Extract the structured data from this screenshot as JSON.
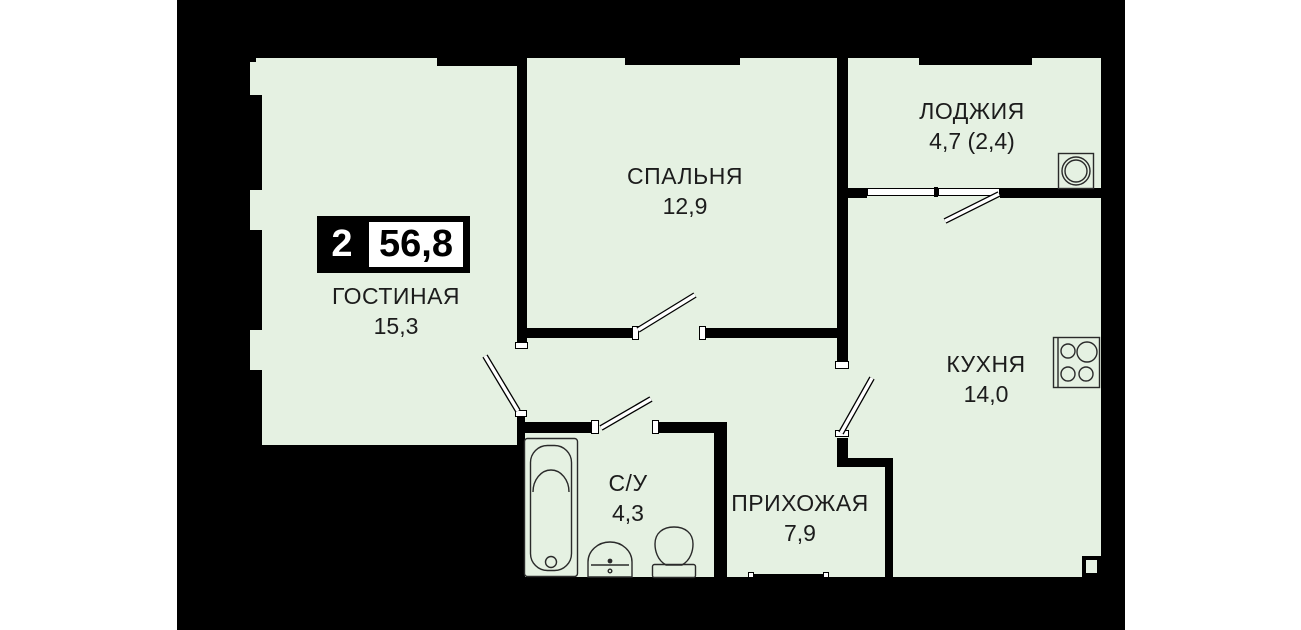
{
  "plan": {
    "type": "apartment-floor-plan",
    "badge": {
      "rooms_count": "2",
      "total_area": "56,8"
    },
    "rooms": [
      {
        "id": "living",
        "name": "ГОСТИНАЯ",
        "area": "15,3"
      },
      {
        "id": "bedroom",
        "name": "СПАЛЬНЯ",
        "area": "12,9"
      },
      {
        "id": "loggia",
        "name": "ЛОДЖИЯ",
        "area": "4,7 (2,4)"
      },
      {
        "id": "kitchen",
        "name": "КУХНЯ",
        "area": "14,0"
      },
      {
        "id": "bathroom",
        "name": "С/У",
        "area": "4,3"
      },
      {
        "id": "hallway",
        "name": "ПРИХОЖАЯ",
        "area": "7,9"
      }
    ],
    "fixtures": [
      "bathtub",
      "sink",
      "toilet",
      "stove",
      "loggia-washer",
      "vent-duct",
      "balcony-window",
      "door-swings"
    ],
    "colors": {
      "background": "#000000",
      "page_margin": "#ffffff",
      "room_fill": "#e5f1e2",
      "wall": "#000000",
      "text": "#1c1c1c",
      "badge_bg": "#000000",
      "badge_box": "#ffffff"
    }
  }
}
